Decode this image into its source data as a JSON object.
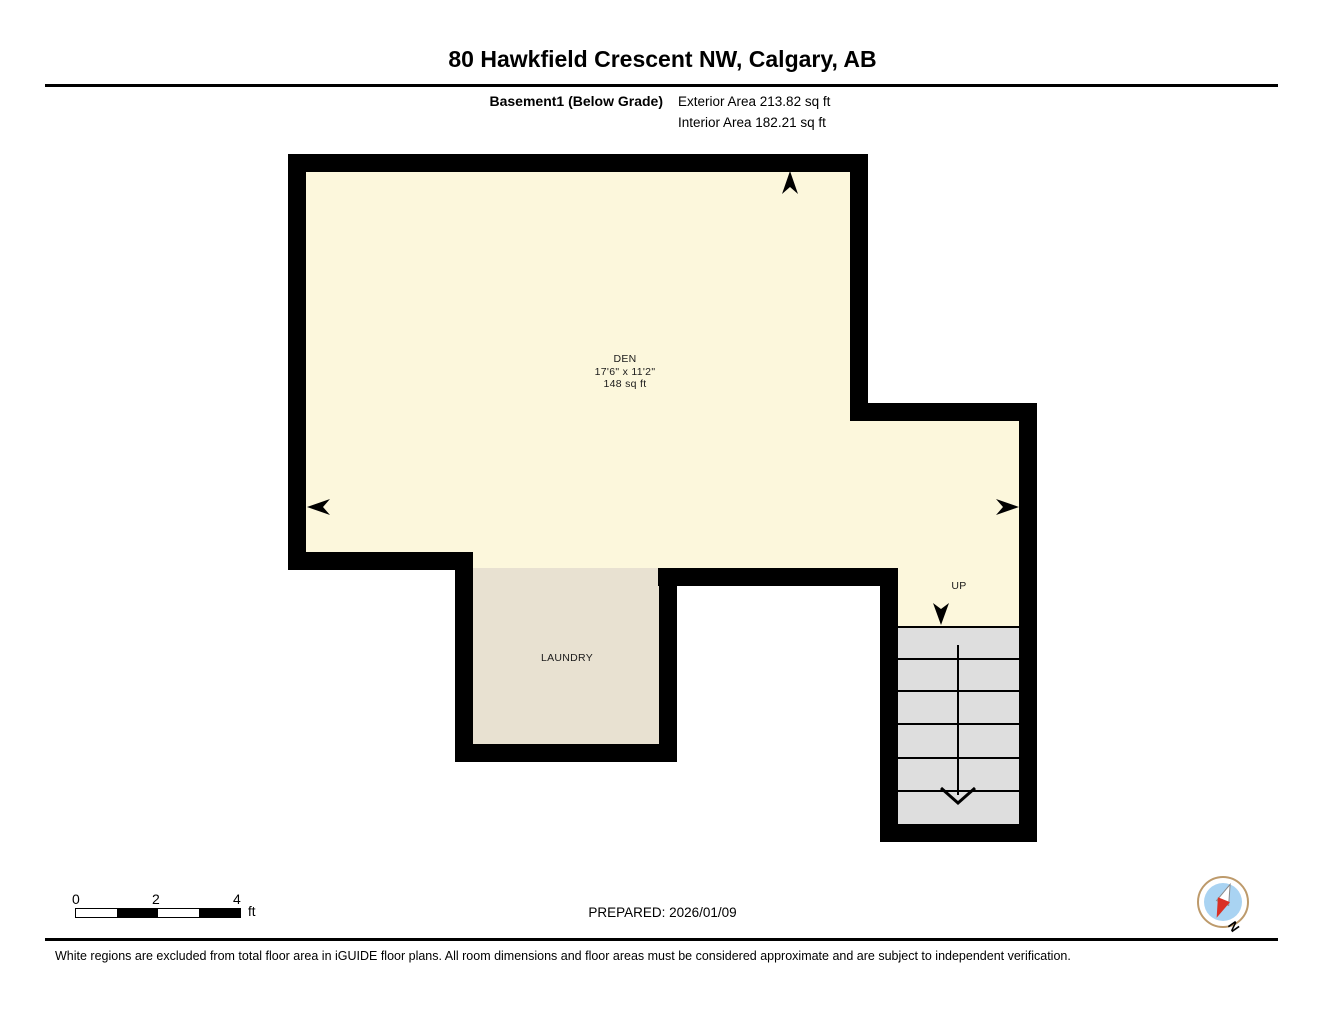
{
  "header": {
    "title": "80 Hawkfield Crescent NW, Calgary, AB",
    "floor_label": "Basement1 (Below Grade)",
    "exterior_area": "Exterior Area 213.82 sq ft",
    "interior_area": "Interior Area 182.21 sq ft"
  },
  "plan": {
    "rooms": [
      {
        "name": "DEN",
        "dimensions": "17'6\" x 11'2\"",
        "area": "148 sq ft"
      },
      {
        "name": "LAUNDRY"
      }
    ],
    "stairs": {
      "label": "UP",
      "treads": 6
    },
    "colors": {
      "wall": "#000000",
      "den_fill": "#FCF7DC",
      "laundry_fill": "#E8E1D1",
      "stairs_fill": "#DEDEDE"
    }
  },
  "footer": {
    "scale_bar": {
      "ticks": [
        "0",
        "2",
        "4"
      ],
      "unit": "ft"
    },
    "prepared": "PREPARED: 2026/01/09",
    "compass": {
      "label": "N",
      "face_color": "#A9D3F2",
      "ring_color": "#BD9A6B",
      "needle_red": "#D93025"
    },
    "disclaimer": "White regions are excluded from total floor area in iGUIDE floor plans. All room dimensions and floor areas must be considered approximate and are subject to independent verification."
  }
}
